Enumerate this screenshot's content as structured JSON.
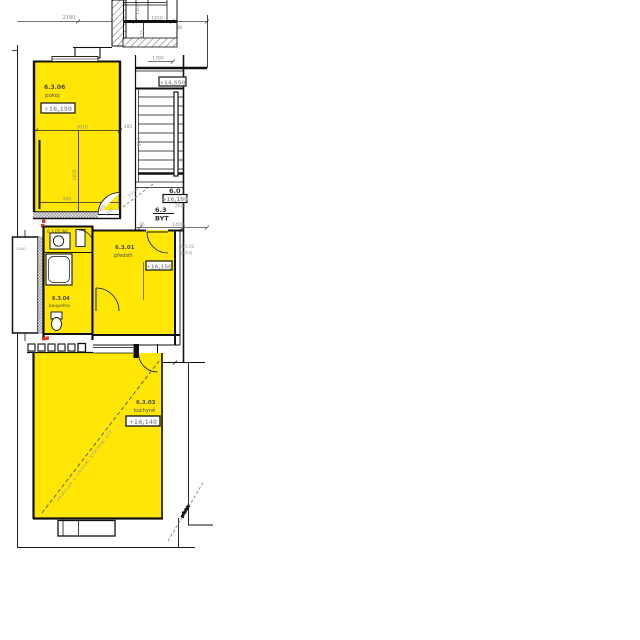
{
  "palette": {
    "highlight": "#ffe605",
    "line": "#000000",
    "dim_text": "#8c8c8c",
    "label_text": "#4a4a4a",
    "level_text": "#9f9f9f",
    "marker_red": "#e33022"
  },
  "flat": {
    "floor_code": "6.0",
    "floor_level": "+16,180",
    "landing_level": "+14,550",
    "flat_code": "6.3",
    "flat_type": "BYT",
    "landing_dim": "2610"
  },
  "rooms": {
    "pokoj": {
      "code": "6.3.06",
      "name": "pokoj",
      "level": "+16,150"
    },
    "predsin": {
      "code": "6.3.01",
      "name": "předsíň",
      "level": "+16,150"
    },
    "kuchyne": {
      "code": "6.3.03",
      "name": "kuchyně",
      "level": "+16,140"
    },
    "koupelna": {
      "code": "6.3.04",
      "name": "koupelna"
    },
    "wc": {
      "label": "6.3.05 WC"
    },
    "vedlejsi": {
      "code": "6.3.02",
      "name": "pokoj"
    }
  },
  "dims": {
    "top_overall": "2190",
    "top_w1": "1100",
    "top_w2": "1850",
    "top_w3": "475",
    "top_w4": "60",
    "stair_width": "1390",
    "shaft_gap": "485",
    "stair_run": "863",
    "pokoj_width": "2610",
    "pokoj_depth": "2435",
    "pokoj_seg": "900",
    "door_width": "800",
    "door_height": "1100",
    "landing_seg1": "60",
    "landing_seg2": "1400",
    "shaft_width": "1400"
  },
  "annotations": {
    "beam_main": "PRŮVLAK V ÚROVNI STROPNÍ KCE",
    "beam_stair": "průvlak",
    "beam_right": "průvlak"
  }
}
